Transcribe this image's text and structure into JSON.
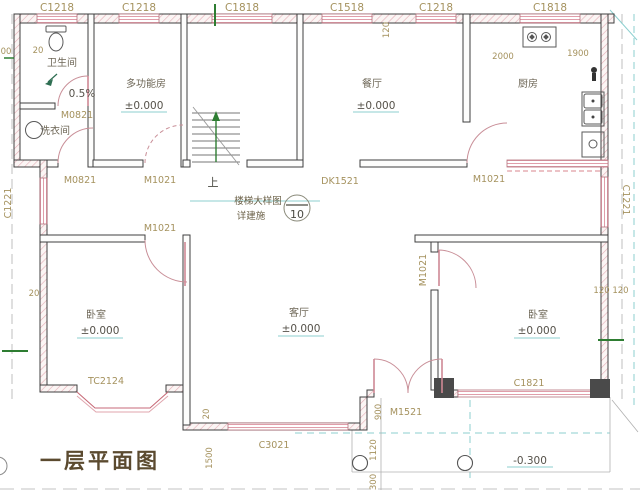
{
  "drawing": {
    "title": "一层平面图",
    "rooms": {
      "bathroom": {
        "name": "卫生间",
        "slope": "0.5%"
      },
      "laundry": {
        "name": "洗衣间"
      },
      "multi_function": {
        "name": "多功能房",
        "elevation": "±0.000"
      },
      "dining": {
        "name": "餐厅",
        "elevation": "±0.000"
      },
      "kitchen": {
        "name": "厨房",
        "dim_left": "2000",
        "dim_right": "1900"
      },
      "living": {
        "name": "客厅",
        "elevation": "±0.000"
      },
      "bedroom_left": {
        "name": "卧室",
        "elevation": "±0.000"
      },
      "bedroom_right": {
        "name": "卧室",
        "elevation": "±0.000"
      }
    },
    "porch": {
      "elevation": "-0.300"
    },
    "stair": {
      "up_label": "上",
      "note_line1": "楼梯大样图",
      "note_line2": "详建施",
      "detail_number": "10"
    },
    "windows": {
      "top": [
        "C1218",
        "C1218",
        "C1818",
        "C1518",
        "C1218",
        "C1818"
      ],
      "left_wall": "C1221",
      "right_wall": "C1221",
      "bay_window": "TC2124",
      "living_south": "C3021",
      "bedroom_south": "C1821"
    },
    "doors": {
      "bathroom": "M0821",
      "laundry": "M0821",
      "multi_function": "M1021",
      "bedroom_left": "M1021",
      "dining_opening": "DK1521",
      "kitchen": "M1021",
      "bedroom_right": "M1021",
      "entry": "M1521"
    },
    "dimensions": {
      "top_left_a": "00",
      "top_left_b": "20",
      "top_rot": "120",
      "left_mid": "20",
      "right_mid": "120 120",
      "entry_900": "900",
      "entry_1120": "1120",
      "entry_300": "300",
      "step_20": "20",
      "porch_1500": "1500"
    }
  }
}
